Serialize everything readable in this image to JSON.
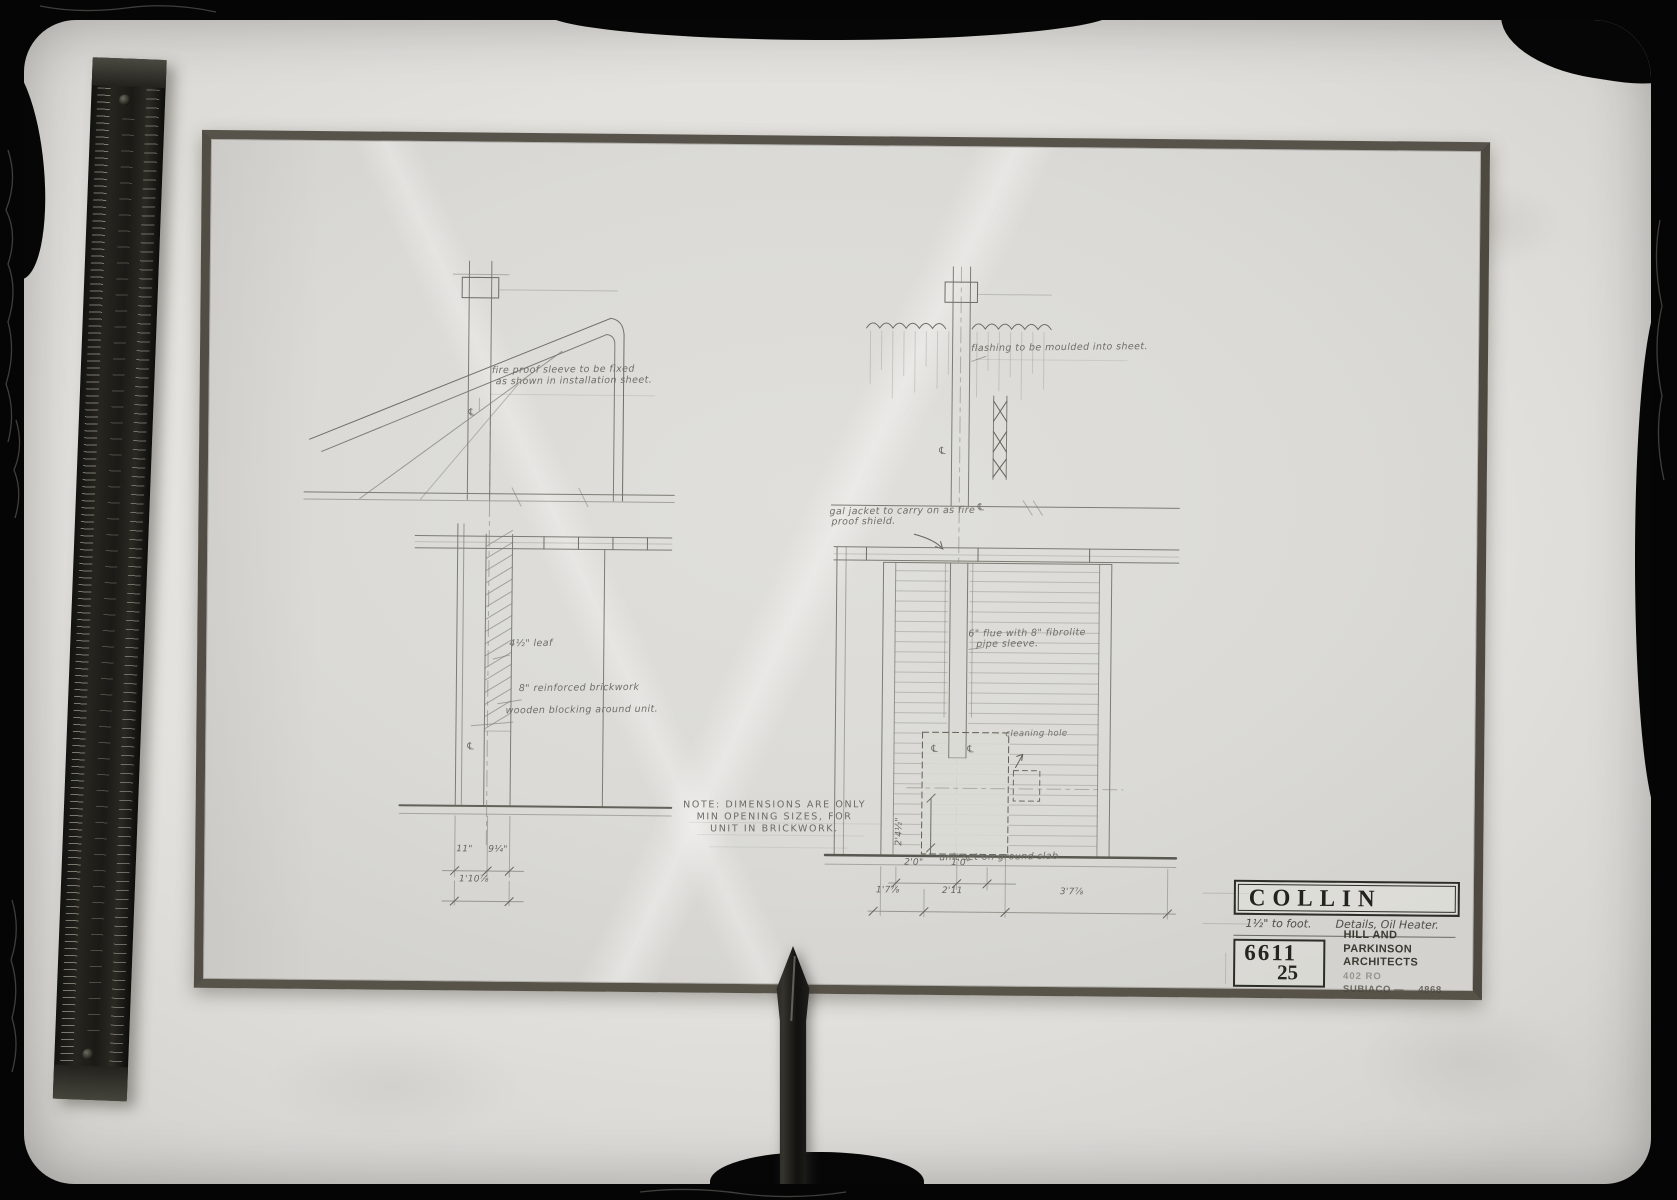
{
  "colors": {
    "background": "#060606",
    "light_table": "#e4e2de",
    "paper": "#dbdad6",
    "tape_border": "#57524a",
    "pencil": "#7c7c74",
    "stamp_ink": "#2d2d28"
  },
  "roof_section": {
    "sleeve_note_1": "fire proof sleeve to be fixed",
    "sleeve_note_2": "as shown in installation sheet.",
    "leaf_label": "4½\" leaf",
    "brickwork_label": "8\" reinforced brickwork",
    "blocking_label": "wooden blocking around unit.",
    "dim_a": "11\"",
    "dim_b": "9¼\"",
    "dim_c": "1'10⅞",
    "centerline_symbol": "℄"
  },
  "flue_section": {
    "flashing_note": "flashing to be moulded into sheet.",
    "jacket_note_1": "gal jacket to carry on as fire",
    "jacket_note_2": "proof shield.",
    "flue_note_1": "6\" flue with 8\" fibrolite",
    "flue_note_2": "pipe sleeve.",
    "cleaning_hole_label": "cleaning hole",
    "slab_label": "unit set on ground slab",
    "dim_2_0": "2'0\"",
    "dim_1_0": "1'0\"",
    "dim_1_7": "1'7⅞",
    "dim_2_11": "2'11",
    "dim_3_7": "3'7⅞",
    "dim_2_4": "2'4½\"",
    "centerline_symbol": "℄"
  },
  "note": {
    "line1": "NOTE: DIMENSIONS ARE ONLY",
    "line2": "MIN OPENING SIZES, FOR",
    "line3": "UNIT IN BRICKWORK."
  },
  "title_block": {
    "client": "COLLIN",
    "scale": "1½\" to foot.",
    "subject": "Details, Oil Heater.",
    "job_number": "6611",
    "sheet_number": "25",
    "firm_name": "HILL AND PARKINSON",
    "firm_type": "ARCHITECTS",
    "firm_address": "402 RO",
    "firm_city": "SUBIACO —",
    "firm_phone": "4868"
  }
}
